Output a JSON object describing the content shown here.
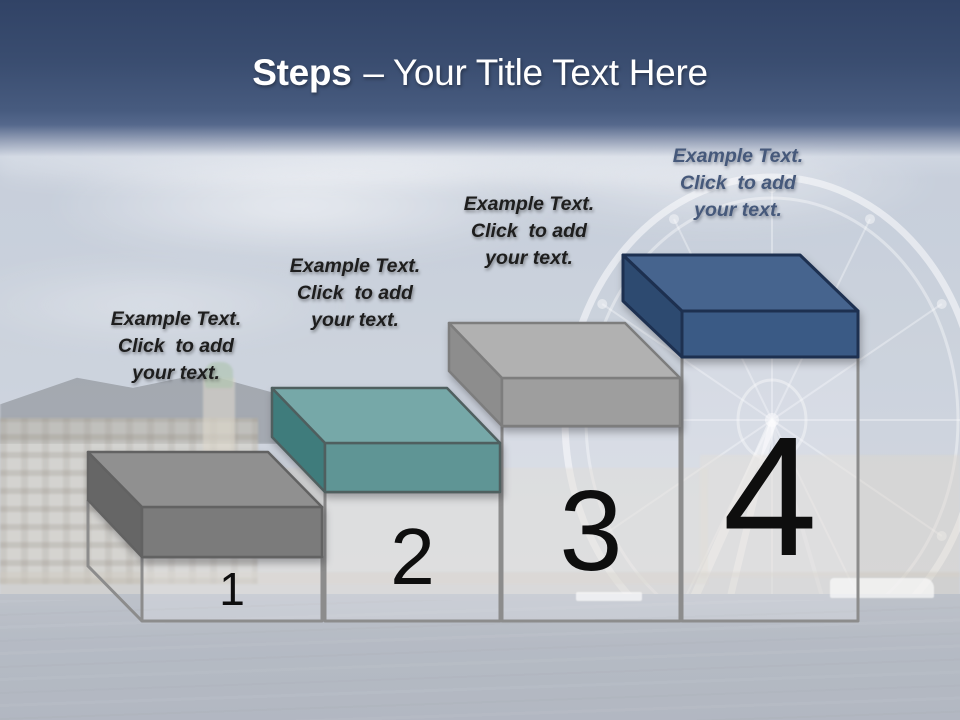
{
  "title": {
    "bold": "Steps",
    "regular": "– Your Title Text Here",
    "color": "#ffffff"
  },
  "steps": [
    {
      "number": "1",
      "text": "Example Text.\nClick  to add\nyour text.",
      "text_color": "#1e1e1e",
      "colors": {
        "top": "#909090",
        "front": "#7b7b7b",
        "side": "#666666",
        "outline": "#626262"
      }
    },
    {
      "number": "2",
      "text": "Example Text.\nClick  to add\nyour text.",
      "text_color": "#1e1e1e",
      "colors": {
        "top": "#76a8a8",
        "front": "#5f9595",
        "side": "#3f7c7c",
        "outline": "#4f5f5f"
      }
    },
    {
      "number": "3",
      "text": "Example Text.\nClick  to add\nyour text.",
      "text_color": "#1e1e1e",
      "colors": {
        "top": "#b1b1b1",
        "front": "#9e9e9e",
        "side": "#8d8d8d",
        "outline": "#7d7d7d"
      }
    },
    {
      "number": "4",
      "text": "Example Text.\nClick  to add\nyour text.",
      "text_color": "#46597b",
      "colors": {
        "top": "#46648e",
        "front": "#3a5a85",
        "side": "#2d4a70",
        "outline": "#1d3050"
      }
    }
  ],
  "diagram": {
    "pedestal_fill": "rgba(250,251,253,0.22)",
    "pedestal_stroke": "#8c8c8c",
    "number_color": "#0e0e0e"
  },
  "theme": {
    "header_top": "#314366",
    "header_bottom": "#55688c",
    "sky": "#bfc8d4",
    "water": "#a3aab5"
  }
}
